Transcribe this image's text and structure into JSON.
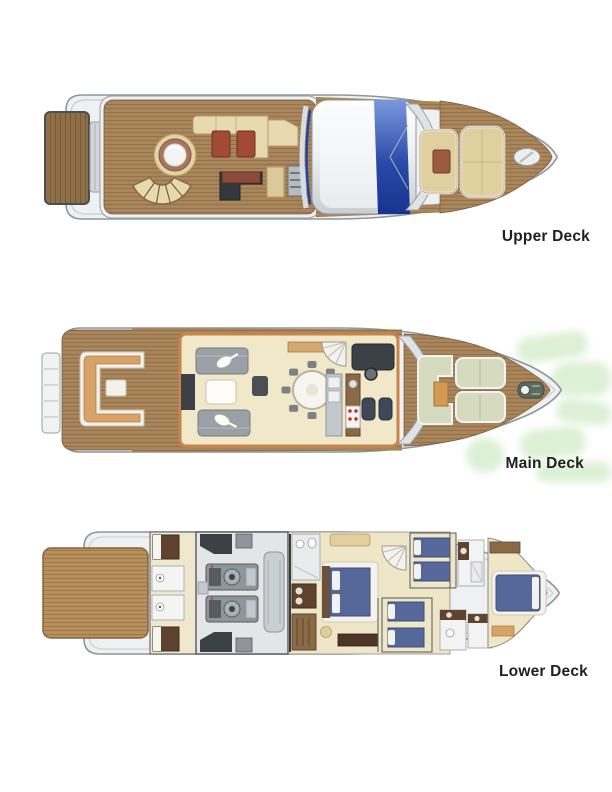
{
  "page": {
    "background": "#ffffff",
    "content": "Three top-view yacht deck plans stacked vertically"
  },
  "decks": [
    {
      "id": "upper-deck",
      "label": "Upper Deck",
      "features": [
        "tender platform",
        "flybridge teak deck",
        "jacuzzi",
        "curved staircase",
        "u-shaped sofa",
        "two cocktail tables",
        "wet bar",
        "helm console",
        "hardtop with blue sunroof",
        "bow sunpads",
        "anchor locker"
      ]
    },
    {
      "id": "main-deck",
      "label": "Main Deck",
      "features": [
        "stern steps",
        "aft deck lounge sofa",
        "salon sofas with guitars",
        "coffee table",
        "round dining table with eight chairs",
        "galley with stove",
        "staircase",
        "helm station with two seats",
        "bow sunpads",
        "anchor windlass"
      ]
    },
    {
      "id": "lower-deck",
      "label": "Lower Deck",
      "features": [
        "swim platform",
        "crew bunk cabins",
        "crew bathrooms",
        "engine room with twin engines",
        "master cabin double bed",
        "master bathroom",
        "wardrobe",
        "staircase",
        "twin guest cabin",
        "double guest cabin",
        "guest bathrooms",
        "vip bow cabin"
      ]
    }
  ],
  "colors": {
    "hull": "#eef0f2",
    "hull_outline": "#8e969c",
    "teak": "#a8855a",
    "teak_dark": "#8f6f48",
    "platform_teak": "#b8905f",
    "cream_upholstery": "#e3d3a4",
    "red_table": "#a14a36",
    "glass_blue": "#24449c",
    "salon_floor": "#f1e7c9",
    "wall_tan": "#c8854a",
    "sofa_gray": "#9aa0a5",
    "bed_blue": "#56689a",
    "sunpad_sage": "#d6dabf",
    "engine_gray": "#8e959b",
    "watermark_green": "#d7eecf",
    "label_text": "#1f1f1f"
  }
}
